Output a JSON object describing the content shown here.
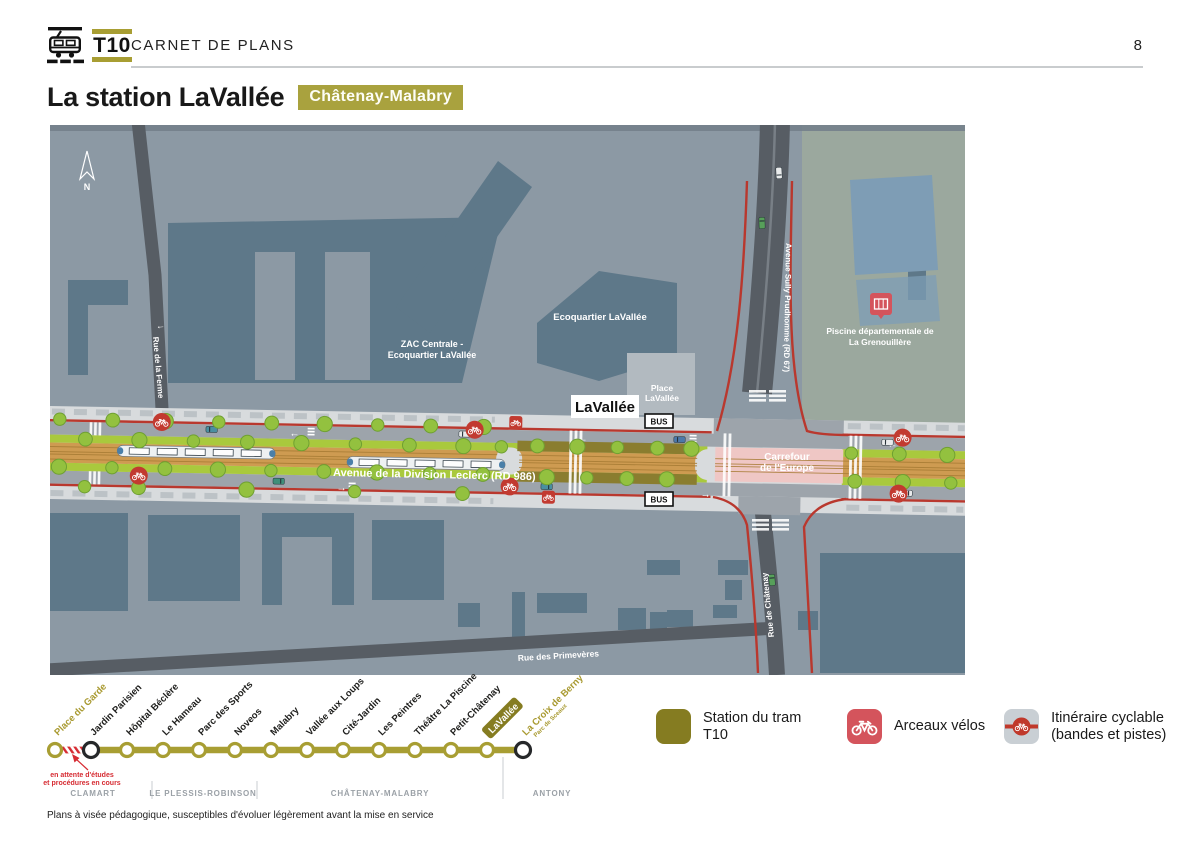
{
  "header": {
    "line_name": "T10",
    "doc_title": "CARNET DE PLANS",
    "page_number": "8"
  },
  "title": {
    "main": "La station LaVallée",
    "city_badge": "Châtenay-Malabry"
  },
  "map": {
    "compass": "N",
    "station_box": "LaVallée",
    "bus_stop": "BUS",
    "areas": {
      "zac_1": "ZAC Centrale -",
      "zac_2": "Ecoquartier LaVallée",
      "ecoquartier": "Ecoquartier LaVallée",
      "place_1": "Place",
      "place_2": "LaVallée",
      "piscine_1": "Piscine départementale de",
      "piscine_2": "La Grenouillère",
      "carrefour_1": "Carrefour",
      "carrefour_2": "de l'Europe"
    },
    "streets": {
      "ferme": "Rue de la Ferme",
      "sully": "Avenue Sully Prudhomme (RD 67)",
      "leclerc": "Avenue de la Division Leclerc (RD 986)",
      "chatenay": "Rue de Châtenay",
      "primeveres": "Rue des Primevères"
    }
  },
  "line_diagram": {
    "stations": [
      {
        "name": "Place du Garde",
        "style": "future"
      },
      {
        "name": "Jardin Parisien",
        "style": "connect"
      },
      {
        "name": "Hôpital Béclère",
        "style": "normal"
      },
      {
        "name": "Le Hameau",
        "style": "normal"
      },
      {
        "name": "Parc des Sports",
        "style": "normal"
      },
      {
        "name": "Noveos",
        "style": "normal"
      },
      {
        "name": "Malabry",
        "style": "normal"
      },
      {
        "name": "Vallée aux Loups",
        "style": "normal"
      },
      {
        "name": "Cité-Jardin",
        "style": "normal"
      },
      {
        "name": "Les Peintres",
        "style": "normal"
      },
      {
        "name": "Théâtre La Piscine",
        "style": "normal"
      },
      {
        "name": "Petit-Châtenay",
        "style": "normal"
      },
      {
        "name": "LaVallée",
        "style": "highlight"
      },
      {
        "name": "La Croix de Berny",
        "style": "terminus",
        "sub": "Parc de Sceaux"
      }
    ],
    "pending_note_1": "en attente d'études",
    "pending_note_2": "et procédures en cours",
    "cities": [
      {
        "name": "CLAMART"
      },
      {
        "name": "LE PLESSIS-ROBINSON"
      },
      {
        "name": "CHÂTENAY-MALABRY"
      },
      {
        "name": "ANTONY"
      }
    ]
  },
  "legend": {
    "items": [
      {
        "icon": "tram-station-square",
        "label": "Station du tram T10"
      },
      {
        "icon": "bike-rack",
        "label": "Arceaux vélos"
      },
      {
        "icon": "cycle-route",
        "label": "Itinéraire cyclable (bandes et pistes)"
      }
    ]
  },
  "footer": {
    "note": "Plans à visée pédagogique, susceptibles d'évoluer légèrement avant la mise en service"
  },
  "colors": {
    "olive": "#857C21",
    "olive_light": "#A89E33",
    "red_route": "#B9382E",
    "red_icon": "#D4545C",
    "map_bg": "#8C99A4",
    "block": "#5E7889",
    "green_strip": "#A9C93D",
    "tram_bed": "#CE9B51"
  }
}
